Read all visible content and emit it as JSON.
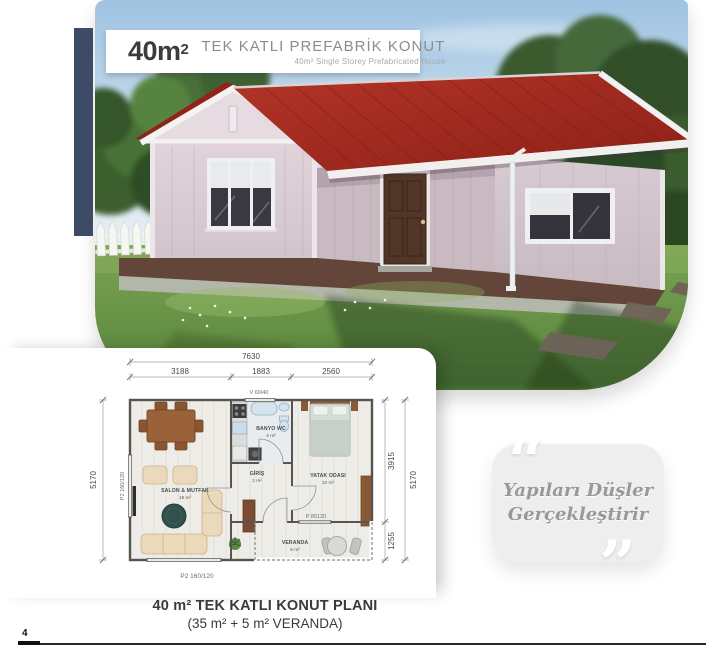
{
  "header": {
    "area": "40m",
    "area_sup": "2",
    "title": "TEK KATLI PREFABRİK KONUT",
    "subtitle": "40m² Single Storey Prefabricated House"
  },
  "plan": {
    "dim_total": "7630",
    "dim_seg1": "3188",
    "dim_seg2": "1883",
    "dim_seg3": "2560",
    "dim_left": "5170",
    "dim_right_outer": "5170",
    "dim_right_top": "3915",
    "dim_right_bottom": "1255",
    "win_top": "V 60/40",
    "win_left": "P2 160/120",
    "win_bottom": "P2 160/120",
    "door_veranda": "P 80120",
    "rooms": [
      {
        "name": "SALON & MUTFAK",
        "area": "19 m²"
      },
      {
        "name": "BANYO WC",
        "area": "4 m²"
      },
      {
        "name": "GİRİŞ",
        "area": "2 m²"
      },
      {
        "name": "YATAK ODASI",
        "area": "10 m²"
      },
      {
        "name": "VERANDA",
        "area": "5 m²"
      }
    ]
  },
  "quote": {
    "open_mark": "“",
    "close_mark": "”",
    "line1": "Yapıları Düşler",
    "line2": "Gerçekleştirir"
  },
  "caption": {
    "title": "40 m² TEK KATLI KONUT PLANI",
    "subtitle": "(35 m² + 5 m² VERANDA)"
  },
  "footer": {
    "page": "4"
  },
  "colors": {
    "accent_navy": "#3d4b66",
    "roof_red": "#a82c20",
    "wall_pink": "#d9ccd3",
    "deck_brown": "#63453a",
    "grass_green": "#5d8a3c",
    "quote_bg": "#eeeeef",
    "quote_text": "#98999b"
  }
}
